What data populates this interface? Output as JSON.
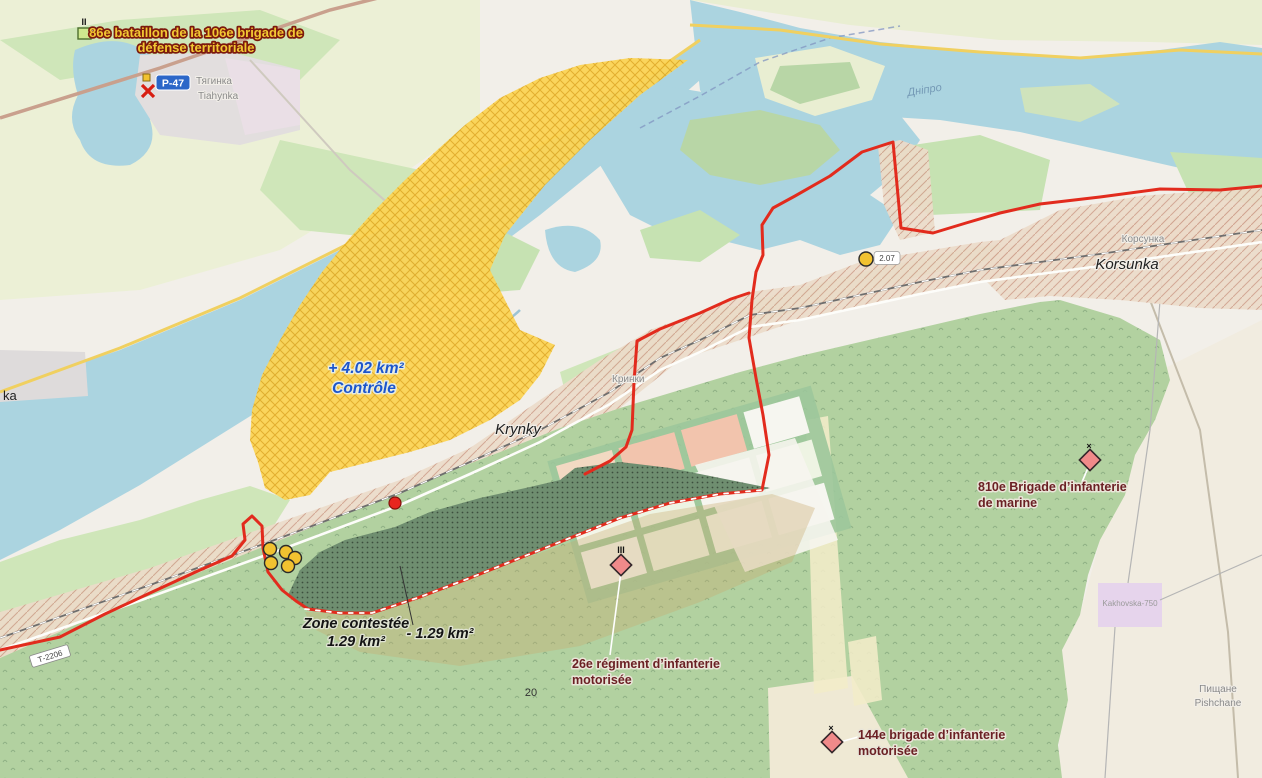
{
  "map": {
    "labels": {
      "u86_1": "86e bataillon de la 106e brigade de",
      "u86_2": "défense territoriale",
      "e86": "II",
      "ctrl_1": "+ 4.02 km²",
      "ctrl_2": "Contrôle",
      "cont_1": "Zone contestée",
      "cont_2": "1.29 km²",
      "loss": "- 1.29 km²",
      "u26_1": "26e régiment d’infanterie",
      "u26_2": "motorisée",
      "e26": "III",
      "u810_1": "810e Brigade d’infanterie",
      "u810_2": "de marine",
      "e810": "×",
      "u144_1": "144e brigade d’infanterie",
      "u144_2": "motorisée",
      "e144": "×",
      "krynky": "Krynky",
      "krynky_cyr": "Кринки",
      "korsunka": "Korsunka",
      "korsunka_cyr": "Корсунка",
      "tiahynka_cyr": "Тягинка",
      "tiahynka": "Tiahynka",
      "ka": "ka",
      "pishchane_cyr": "Пищане",
      "pishchane": "Pishchane",
      "substation": "Kakhovska-750",
      "dnipro": "Дніпро",
      "parcel20": "20",
      "p47": "P-47",
      "t2206": "Т-2206",
      "m207": "2.07"
    },
    "colors": {
      "control_yellow": "#fbd455",
      "occupied_tan": "#ecdbc9",
      "contested_green": "#6f8e70",
      "frontline_red": "#e22b1d",
      "unit_pink": "#f08a8a",
      "marker_yellow": "#f2c230",
      "marker_red": "#e8251f",
      "water": "#abd4e0",
      "forest": "#b2d1a0",
      "shield_blue": "#2b66c8"
    }
  }
}
